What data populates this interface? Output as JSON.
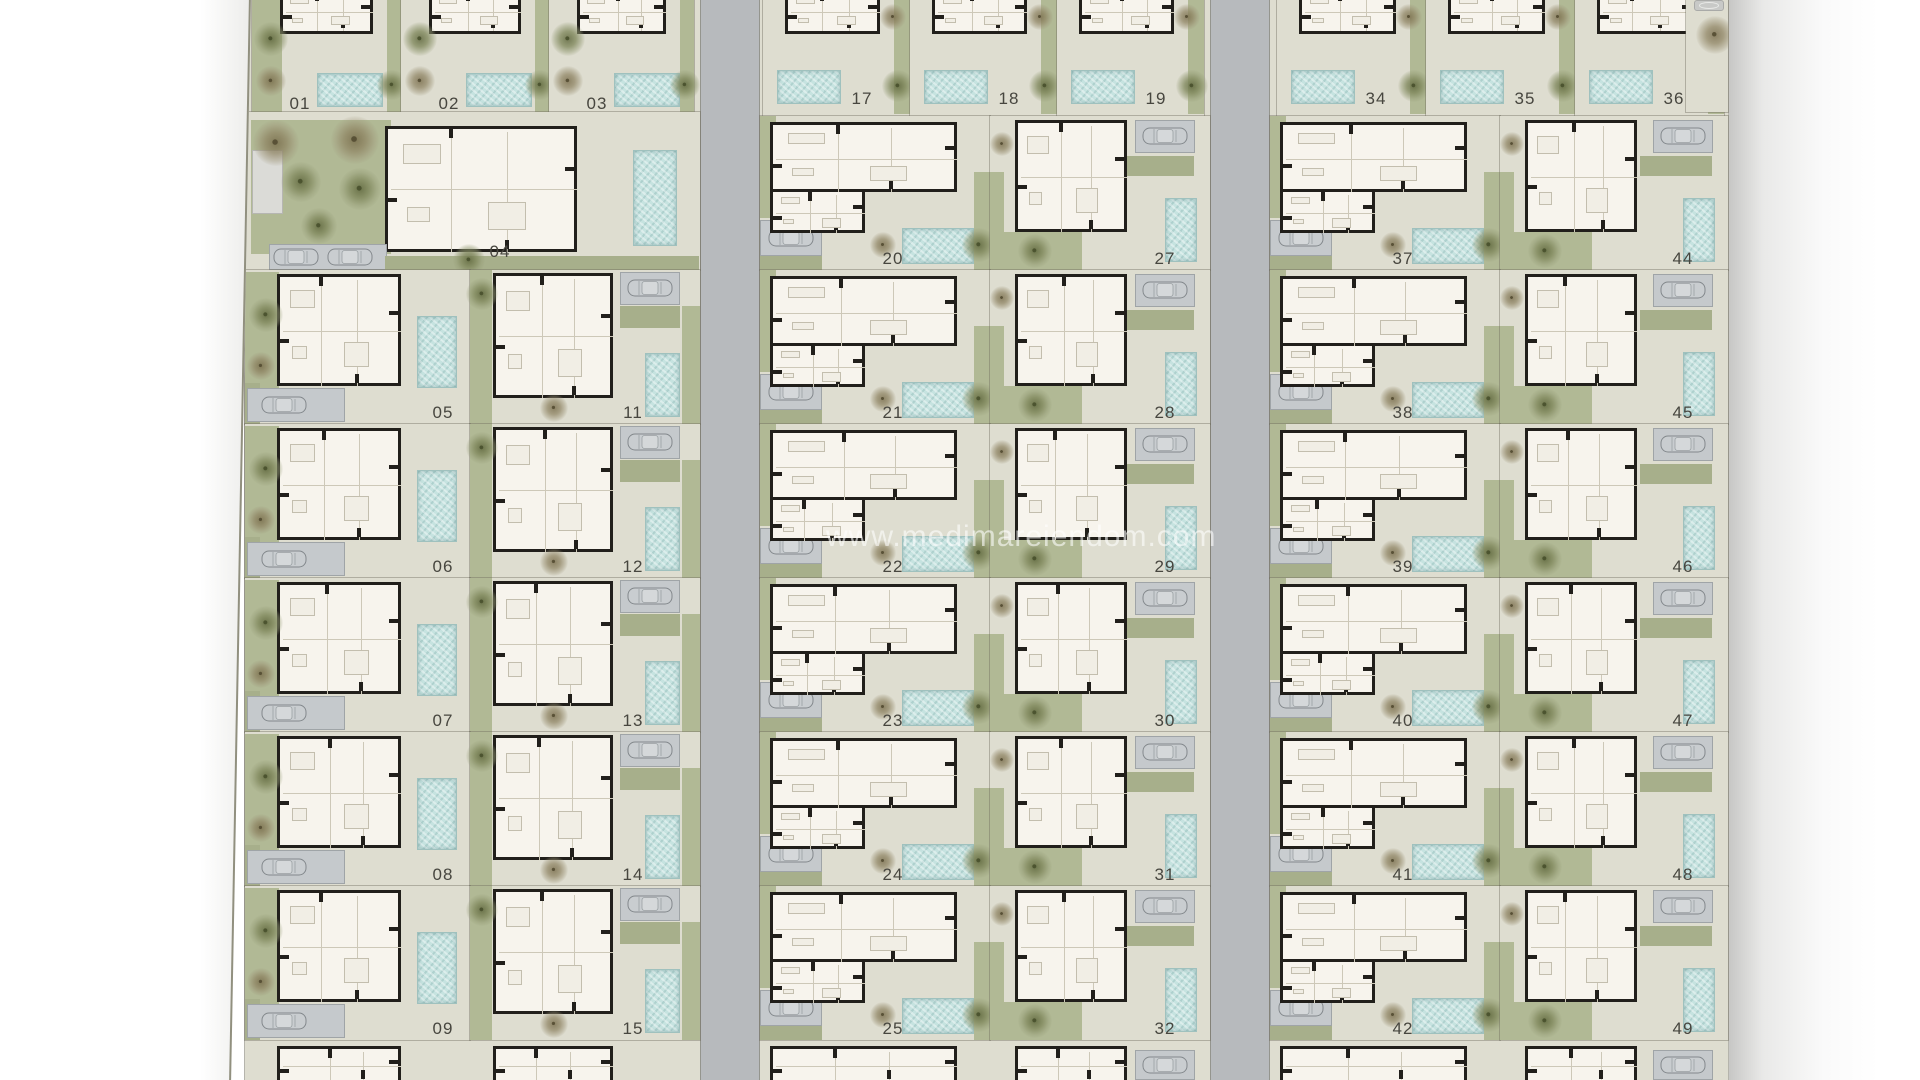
{
  "watermark": {
    "text": "www.medimareiendom.com"
  },
  "colors": {
    "road": "#b7babd",
    "terrace": "#deddd0",
    "garden_green": "#b1b995",
    "pool_water": "#c6e3e0",
    "villa_interior": "#f7f4ed",
    "wall_black": "#211f1b",
    "parking_pad": "#c5c9cc",
    "number_text": "#47463f",
    "paper_white": "#ffffff"
  },
  "icons": {
    "car-icon": "top-view car outline",
    "tree-icon": "round canopy blob",
    "pool-icon": "textured water rectangle",
    "garage-icon": "gray storage rectangle",
    "spa-icon": "small oval basin"
  },
  "plan": {
    "groups": [
      {
        "name": "west-block",
        "top_plots": [
          "01",
          "02",
          "03"
        ],
        "big_plot": "04",
        "rows": [
          {
            "left": "05",
            "right": "11"
          },
          {
            "left": "06",
            "right": "12"
          },
          {
            "left": "07",
            "right": "13"
          },
          {
            "left": "08",
            "right": "14"
          },
          {
            "left": "09",
            "right": "15"
          }
        ]
      },
      {
        "name": "center-block",
        "top_plots": [
          "17",
          "18",
          "19"
        ],
        "rows": [
          {
            "left": "20",
            "right": "27"
          },
          {
            "left": "21",
            "right": "28"
          },
          {
            "left": "22",
            "right": "29"
          },
          {
            "left": "23",
            "right": "30"
          },
          {
            "left": "24",
            "right": "31"
          },
          {
            "left": "25",
            "right": "32"
          }
        ]
      },
      {
        "name": "east-block",
        "top_plots": [
          "34",
          "35",
          "36"
        ],
        "rows": [
          {
            "left": "37",
            "right": "44"
          },
          {
            "left": "38",
            "right": "45"
          },
          {
            "left": "39",
            "right": "46"
          },
          {
            "left": "40",
            "right": "47"
          },
          {
            "left": "41",
            "right": "48"
          },
          {
            "left": "42",
            "right": "49"
          }
        ]
      }
    ]
  }
}
